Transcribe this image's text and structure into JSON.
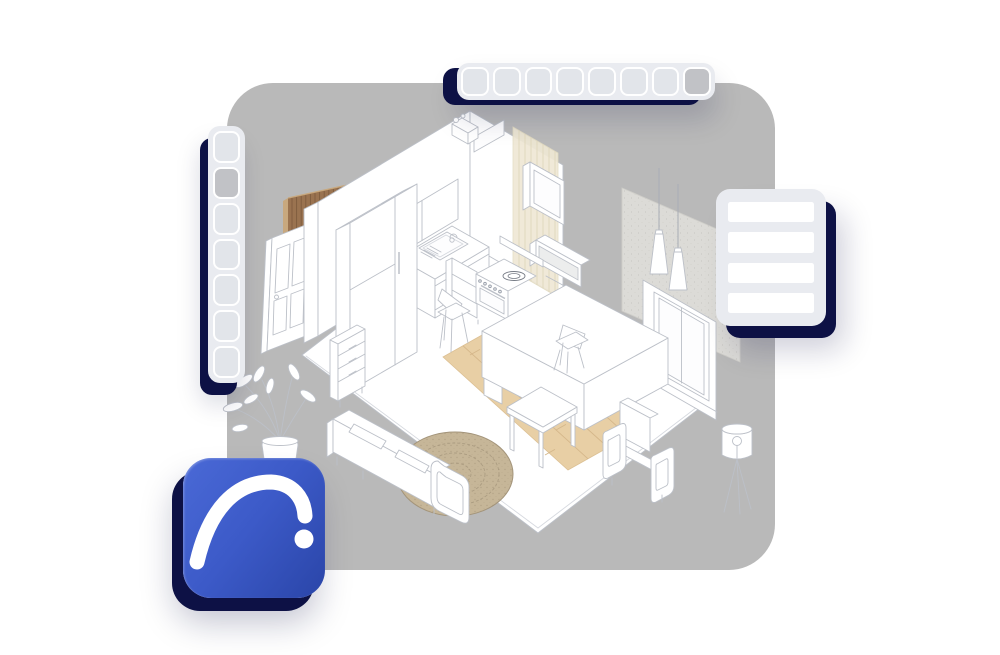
{
  "page": {
    "background_color": "#ffffff"
  },
  "canvas": {
    "color": "#b9b9b9",
    "corner_radius_px": 46
  },
  "palette": {
    "page-bg": "#ffffff",
    "canvas-color": "#b9b9b9",
    "panel-bg": "#e9ebf0",
    "button-bg": "#e2e5ea",
    "button-border": "#ffffff",
    "button-selected": "#c1c2c6",
    "row-bg": "#ffffff",
    "shadow-navy": "#0d1145",
    "line": "#bcc0c8",
    "line-soft": "#d6d9df",
    "wood-panel": "#9a7350",
    "wood-panel-line": "#7a583c",
    "wood-panel-light": "#c8a87e",
    "wood-floor": "#e8cfa5",
    "wood-floor-line": "#d5b78a",
    "rug-fill": "#c6b698",
    "rug-ring": "#a3947a",
    "tile-fill": "#efe8d5",
    "tile-line": "#ded5b8",
    "concrete-fill": "#dcdbd7",
    "icon-grad-1": "#4a69d6",
    "icon-grad-2": "#3c5ac8",
    "icon-grad-3": "#2a45a8",
    "icon-glyph": "#ffffff"
  },
  "toolbar_top": {
    "button_count": 8,
    "selected_index": 7
  },
  "toolbar_left": {
    "button_count": 7,
    "selected_index": 1
  },
  "right_panel": {
    "row_count": 4
  },
  "app_icon": {
    "name": "archicad-arc-logo",
    "glyph": "white arc stroke with dot"
  },
  "scene": {
    "description": "Isometric line-art studio apartment illustration",
    "items": [
      "floor",
      "kitchen-wall",
      "upper-cabinets",
      "fridge-cabinet",
      "sink-counter",
      "oven-cabinet",
      "stove",
      "tile-splashback",
      "mirror-cabinet",
      "wall-glass-cabinet",
      "kitchen-island",
      "bar-chair-left",
      "bar-chair-right",
      "wood-floor-strip",
      "coffee-table",
      "rug",
      "sofa",
      "drawer-unit",
      "armchair",
      "window-wall",
      "concrete-panel",
      "pendant-lamps",
      "door",
      "wood-slat-panel",
      "plant",
      "floor-lamp",
      "vent-box"
    ]
  }
}
